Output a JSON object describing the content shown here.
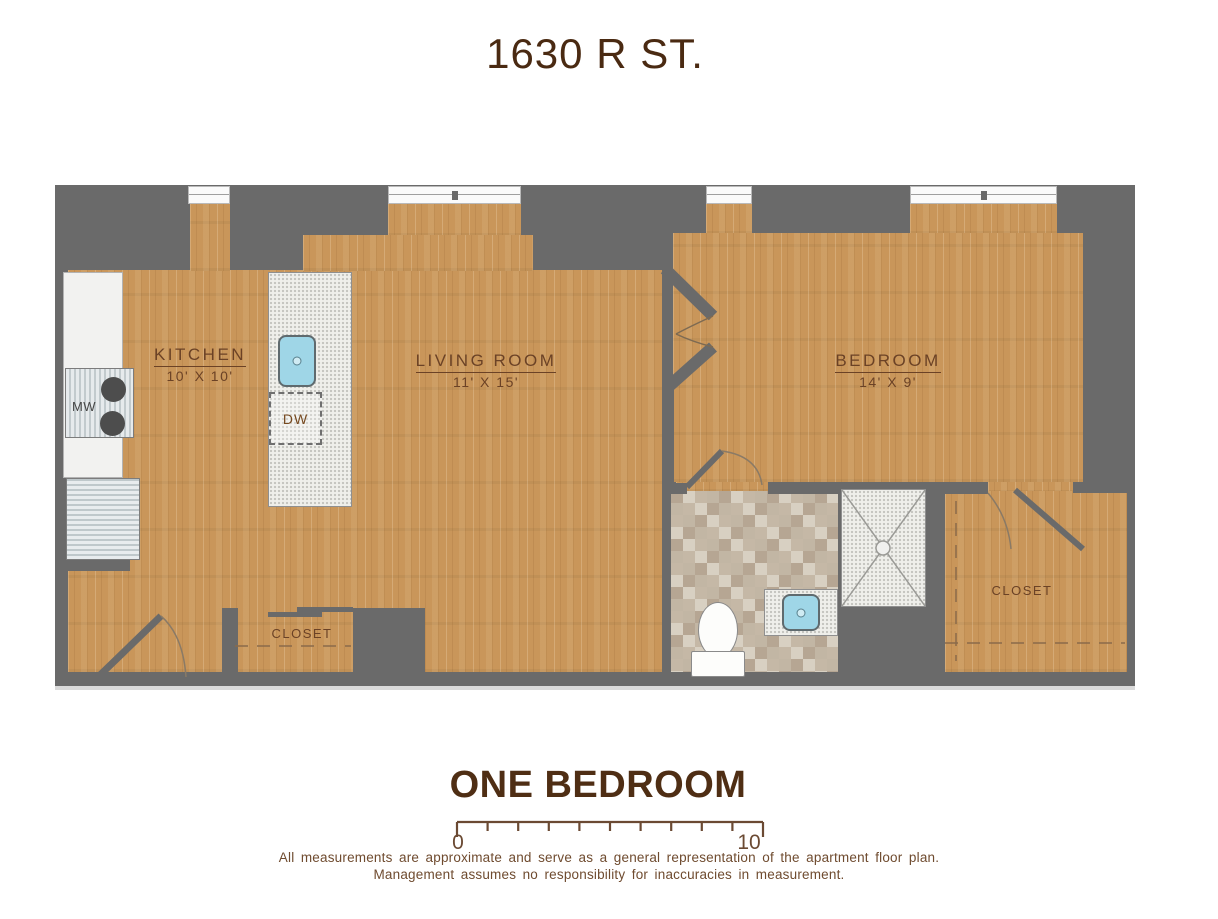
{
  "title": "1630 R ST.",
  "plan_type": "ONE BEDROOM",
  "rooms": {
    "kitchen": {
      "name": "KITCHEN",
      "dims": "10' X 10'"
    },
    "living_room": {
      "name": "LIVING ROOM",
      "dims": "11' X 15'"
    },
    "bedroom": {
      "name": "BEDROOM",
      "dims": "14' X 9'"
    },
    "closet_hall": {
      "name": "CLOSET"
    },
    "closet_bedroom": {
      "name": "CLOSET"
    }
  },
  "fixtures": {
    "microwave_label": "MW",
    "dishwasher_label": "DW"
  },
  "scale_bar": {
    "start_label": "0",
    "end_label": "10",
    "segments": 10
  },
  "disclaimer": [
    "All measurements are approximate and serve as a general representation of the apartment floor plan.",
    "Management assumes no responsibility for inaccuracies in measurement."
  ],
  "colors": {
    "wall_gray": "#6a6a6a",
    "wood_tan": "#c9965a",
    "label_brown": "#6b4226",
    "sink_blue": "#9fd6e7",
    "tile_base": "#cdc2b2"
  }
}
